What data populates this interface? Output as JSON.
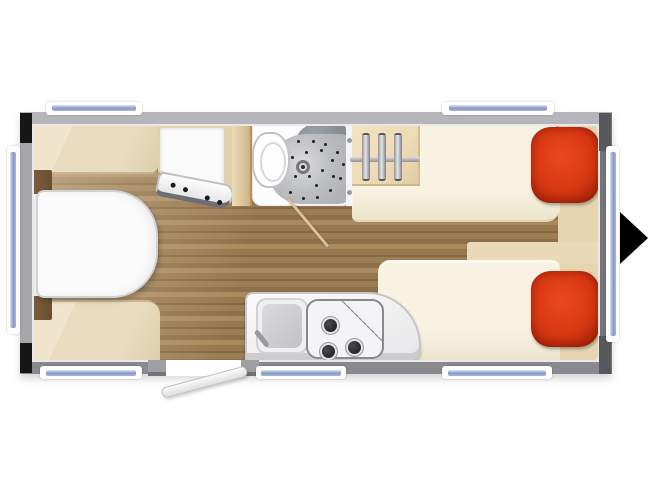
{
  "title": "caravan-floor-plan-top-view",
  "canvas": {
    "width": 650,
    "height": 487
  },
  "palette": {
    "wall": "#a6a6aa",
    "wall-light": "#b6b6ba",
    "wall-edge": "#747479",
    "wall-bottom": "#8a8a8e",
    "trim-black": "#161616",
    "trim-gray": "#57575c",
    "glass": "#8598c4",
    "glass-light": "#dde4f2",
    "frame": "#ffffff",
    "wood": "#97784f",
    "wood-dark": "#856743",
    "wood-light": "#a98a5e",
    "upholstery": "#e8dbbf",
    "cushion": "#6b4e31",
    "table": "#fbfbfb",
    "mattress": "#f4efdf",
    "mattress-edge": "#ddd3b8",
    "pillow": "#d63812",
    "pillow-dark": "#a82407",
    "beige-panel": "#e7d5b1",
    "wardrobe": "#eedcb6",
    "partition-light": "#ecdcbc",
    "partition-dark": "#cfb384",
    "bath-floor": "#fcfcfd",
    "shower": "#b2b3b6",
    "basin": "#878b92",
    "counter": "#f3f3f5",
    "counter-edge": "#c6c6c9",
    "burner": "#28282a",
    "steel": "#9a9a9e",
    "door-leaf": "#f2f2f4",
    "bath-door": "#d8c298",
    "arrow": "#000000"
  },
  "rooms": {
    "dinette": {
      "items": [
        "rounded-table",
        "rear-bench",
        "front-bench",
        "two-dark-side-cushions"
      ]
    },
    "bathroom": {
      "items": [
        "toilet",
        "shower-tray",
        "floor-drain",
        "washbasin",
        "open-door-leaf",
        "towel-hooks"
      ],
      "shower_dots": [
        [
          18,
          14
        ],
        [
          34,
          9
        ],
        [
          52,
          8
        ],
        [
          68,
          13
        ],
        [
          82,
          24
        ],
        [
          90,
          42
        ],
        [
          86,
          62
        ],
        [
          74,
          78
        ],
        [
          58,
          88
        ],
        [
          40,
          90
        ],
        [
          24,
          82
        ],
        [
          13,
          66
        ],
        [
          12,
          48
        ],
        [
          26,
          32
        ],
        [
          44,
          24
        ],
        [
          62,
          22
        ],
        [
          76,
          36
        ],
        [
          64,
          50
        ],
        [
          48,
          58
        ],
        [
          30,
          58
        ],
        [
          56,
          72
        ],
        [
          78,
          58
        ],
        [
          40,
          42
        ],
        [
          20,
          24
        ]
      ]
    },
    "wardrobe": {
      "hanger_count": 3,
      "hanger_offsets": [
        10,
        26,
        42
      ]
    },
    "bedroom": {
      "bed_count": 2,
      "pillows": 2,
      "pillow_color": "#d63812"
    },
    "kitchen": {
      "burner_count": 3,
      "burner_positions": [
        [
          16,
          18
        ],
        [
          14,
          44
        ],
        [
          40,
          40
        ]
      ],
      "items": [
        "sink",
        "faucet",
        "three-burner-hob"
      ]
    },
    "entrance": {
      "door_state": "open",
      "travel_arrow_direction": "right"
    }
  },
  "windows": {
    "top": 2,
    "bottom": 3,
    "left": 1,
    "right": 1,
    "total": 7
  },
  "drawer_knobs": [
    [
      12,
      7
    ],
    [
      25,
      9
    ],
    [
      48,
      13
    ],
    [
      61,
      15
    ]
  ],
  "towel_hooks": [
    [
      0,
      14
    ],
    [
      0,
      66
    ]
  ]
}
